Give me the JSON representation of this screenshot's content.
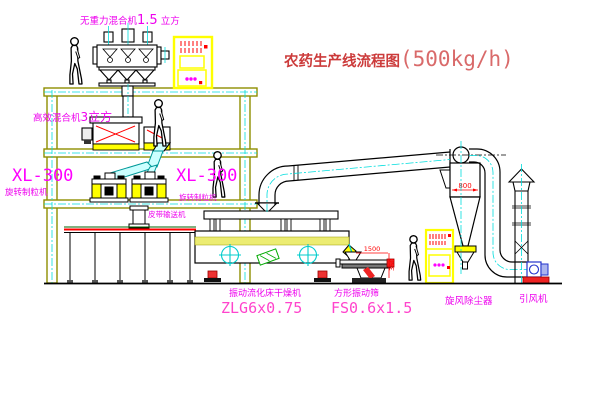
{
  "title": {
    "name": "农药生产线流程图",
    "capacity": "(500kg/h)"
  },
  "equipment_labels": {
    "gravity_free_mixer": {
      "name": "无重力混合机",
      "size": "1.5",
      "unit": " 立方"
    },
    "high_efficiency_mixer": {
      "name": "高效混合机",
      "size": "3立方"
    },
    "granulator_left": {
      "model": "XL-300",
      "name": "旋转制粒机"
    },
    "granulator_mid": {
      "model": "XL-300",
      "name": "旋转制粒机"
    },
    "belt_conveyor": {
      "name": "皮带输送机"
    },
    "fluid_bed_dryer": {
      "name": "振动流化床干燥机",
      "model": "ZLG6x0.75"
    },
    "square_sieve": {
      "name": "方形振动筛",
      "model": "FS0.6x1.5"
    },
    "cyclone_dust_collector": {
      "name": "旋风除尘器"
    },
    "induced_draft_fan": {
      "name": "引风机"
    }
  },
  "dimensions": {
    "cyclone_body": "800",
    "sieve_length": "1500",
    "sieve_height": "350"
  },
  "colors": {
    "structure_olive": "#8f8f00",
    "machine_outline": "#000000",
    "highlight_yellow": "#ffff00",
    "centerline_cyan": "#00dddd",
    "label_magenta": "#ff00ff",
    "title_red": "#cc3b3b",
    "dimension_red": "#ff0000"
  }
}
